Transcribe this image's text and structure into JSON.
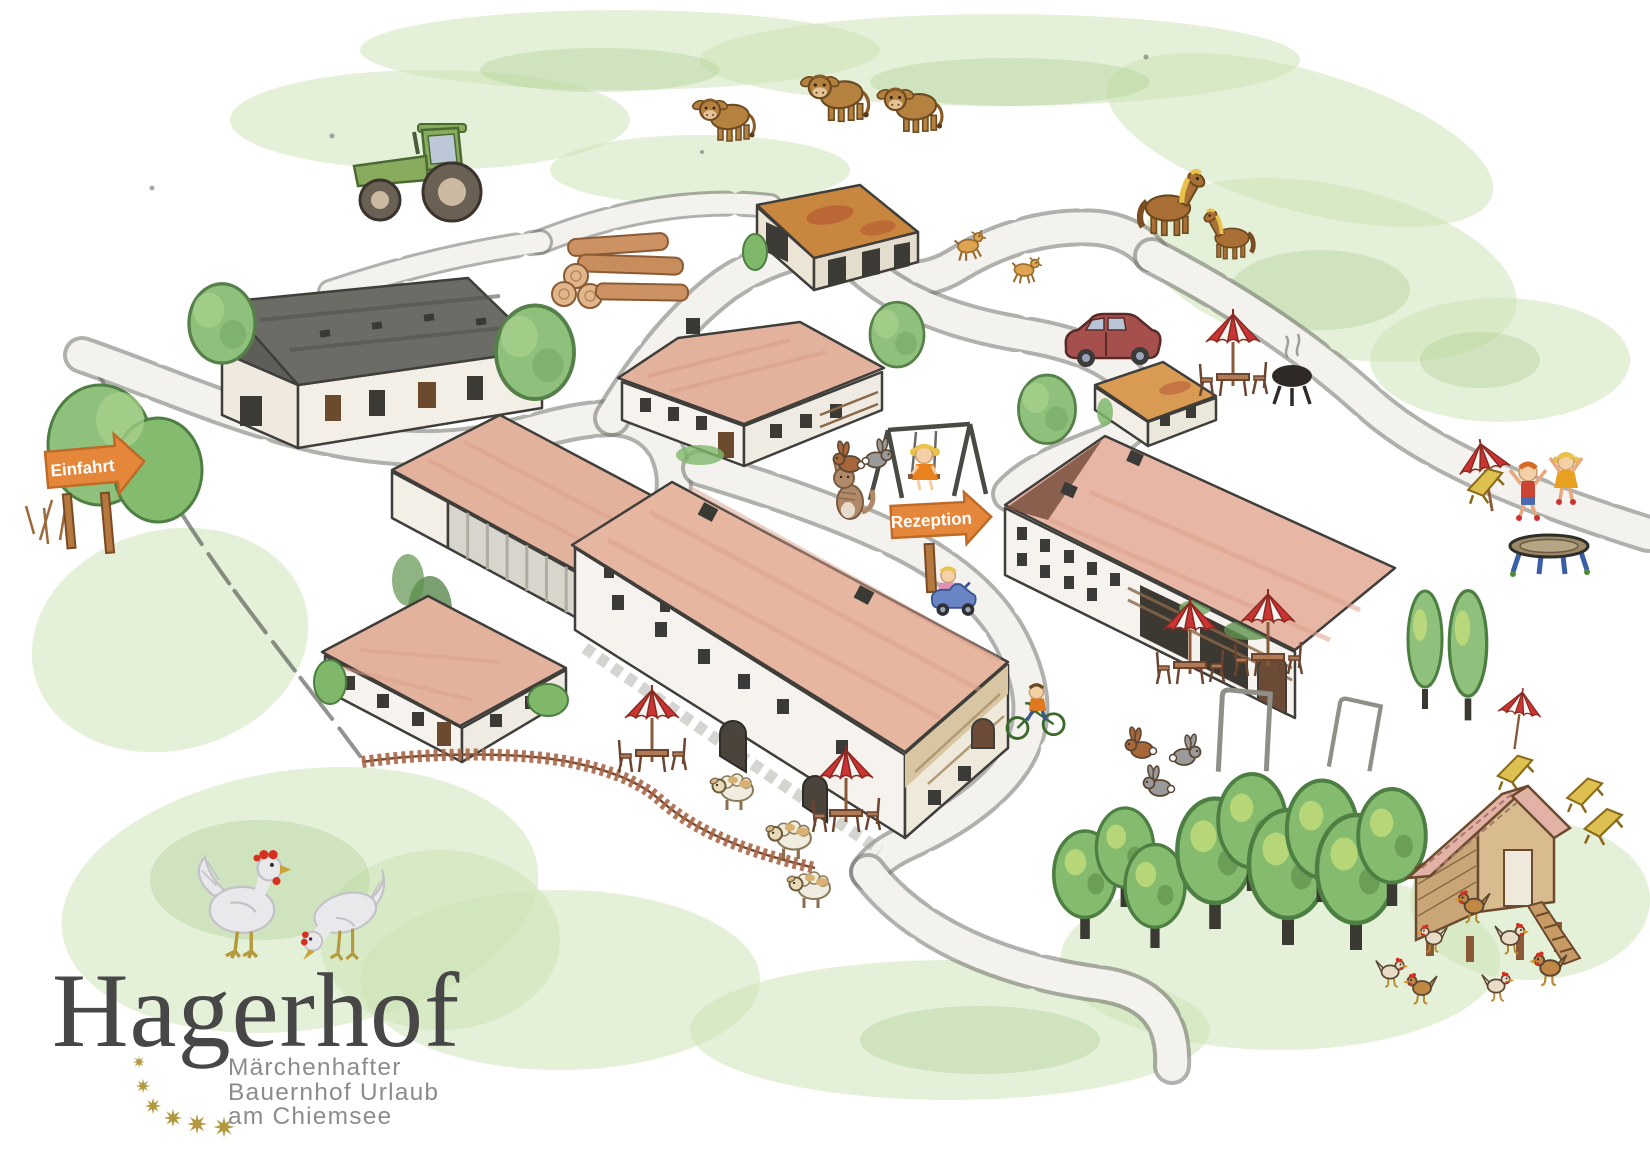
{
  "signs": {
    "einfahrt": {
      "label": "Einfahrt"
    },
    "rezeption": {
      "label": "Rezeption"
    },
    "arrow_color": "#e5873b",
    "post_color": "#b5793f",
    "text_color": "#ffffff"
  },
  "logo": {
    "title": "Hagerhof",
    "tagline": [
      "Märchenhafter",
      "Bauernhof Urlaub",
      "am Chiemsee"
    ],
    "title_color": "#474747",
    "tagline_color": "#8c8c8c",
    "star_color": "#b2993f",
    "star_count": 6,
    "hen_count": 2
  },
  "palette": {
    "roof_salmon": "#e3b29d",
    "roof_dark_barn": "#6b6c66",
    "roof_orange_barn": "#c9863f",
    "wall_white": "#f6f3ee",
    "grass_green": "#cde3b8",
    "tree_green": "#85bb6f",
    "umbrella_red": "#cc3434",
    "lounger_yellow": "#ddc050",
    "tractor_green": "#8aab5e",
    "car_red": "#a6504e",
    "road_edge": "#6f6f6a"
  },
  "features": {
    "buildings": [
      "machine-hall-barn",
      "field-barn",
      "middle-farmhouse",
      "small-house-at-parking",
      "long-barn",
      "main-farmhouse",
      "guest-house",
      "south-west-house",
      "chicken-coop"
    ],
    "animals": {
      "calves": 3,
      "goats": 2,
      "horses": 2,
      "cat": 1,
      "rabbits": 5,
      "sheep": 3,
      "chickens": 7,
      "logo_hens": 2
    },
    "play": [
      "swing-with-girl",
      "trampoline",
      "jumping-kids",
      "kid-on-bobby-car",
      "kid-on-bike",
      "swing-frames"
    ],
    "amenities": [
      "umbrella-seating",
      "bbq-grill",
      "beach-loungers",
      "parked-car",
      "tractor",
      "wood-pile",
      "picket-fence",
      "orchard"
    ]
  }
}
